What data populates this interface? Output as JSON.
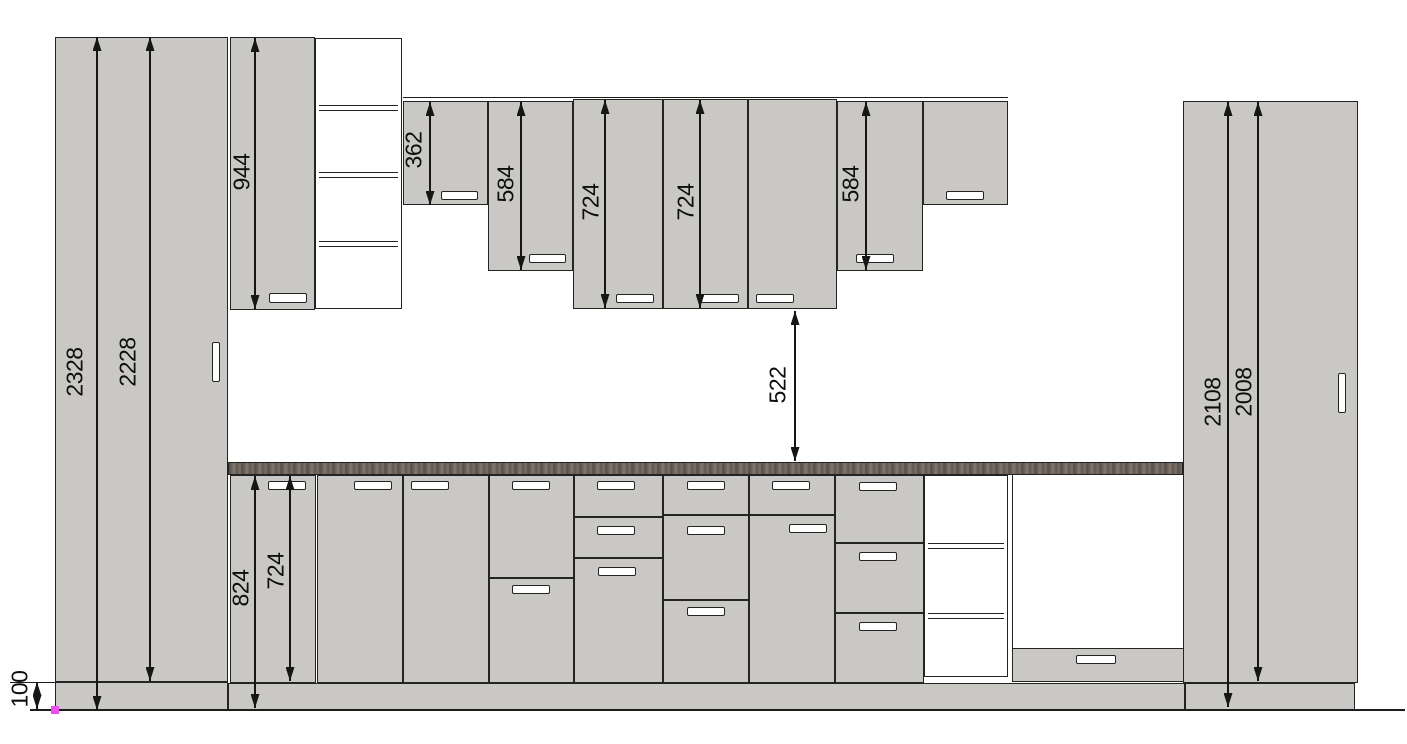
{
  "title": "Kitchen cabinet elevation drawing",
  "units": "mm",
  "colors": {
    "cabinet_fill": "#c9c8c4",
    "outline": "#242424",
    "countertop_dark": "#564e47",
    "countertop_light": "#837970",
    "handle_fill": "#ffffff",
    "dimension": "#161616",
    "origin_marker": "#f24bf2",
    "background": "#ffffff"
  },
  "drawing": {
    "width": 1407,
    "height": 744,
    "rects": [
      {
        "n": "tall-cabinet-left-body",
        "x": 55,
        "y": 37,
        "w": 173,
        "h": 645,
        "f": "cab"
      },
      {
        "n": "tall-cabinet-left-plinth",
        "x": 55,
        "y": 682,
        "w": 173,
        "h": 28,
        "f": "cab"
      },
      {
        "n": "wall-cabinet-944",
        "x": 230,
        "y": 37,
        "w": 85,
        "h": 273,
        "f": "cab"
      },
      {
        "n": "upper-open-shelf-unit",
        "x": 315,
        "y": 38,
        "w": 87,
        "h": 271,
        "f": "white"
      },
      {
        "n": "wall-cabinet-362",
        "x": 403,
        "y": 101,
        "w": 85,
        "h": 104,
        "f": "cab"
      },
      {
        "n": "wall-cabinet-584-left",
        "x": 488,
        "y": 101,
        "w": 85,
        "h": 170,
        "f": "cab"
      },
      {
        "n": "wall-cabinet-724-left",
        "x": 573,
        "y": 99,
        "w": 90,
        "h": 210,
        "f": "cab"
      },
      {
        "n": "wall-cabinet-724-right",
        "x": 663,
        "y": 99,
        "w": 85,
        "h": 210,
        "f": "cab"
      },
      {
        "n": "wall-cabinet-wide",
        "x": 748,
        "y": 99,
        "w": 89,
        "h": 210,
        "f": "cab"
      },
      {
        "n": "wall-cabinet-584-right",
        "x": 837,
        "y": 101,
        "w": 86,
        "h": 170,
        "f": "cab"
      },
      {
        "n": "wall-cabinet-right-end",
        "x": 923,
        "y": 101,
        "w": 85,
        "h": 104,
        "f": "cab"
      },
      {
        "n": "countertop",
        "x": 228,
        "y": 462,
        "w": 955,
        "h": 13,
        "f": "counter"
      },
      {
        "n": "base-door-1",
        "x": 230,
        "y": 475,
        "w": 86,
        "h": 208,
        "f": "cab"
      },
      {
        "n": "base-door-2",
        "x": 317,
        "y": 475,
        "w": 86,
        "h": 208,
        "f": "cab"
      },
      {
        "n": "base-door-3",
        "x": 403,
        "y": 475,
        "w": 86,
        "h": 208,
        "f": "cab"
      },
      {
        "n": "base-4-upper-door",
        "x": 489,
        "y": 475,
        "w": 85,
        "h": 103,
        "f": "cab"
      },
      {
        "n": "base-4-lower-door",
        "x": 489,
        "y": 578,
        "w": 85,
        "h": 105,
        "f": "cab"
      },
      {
        "n": "base-5-drawer-1",
        "x": 574,
        "y": 475,
        "w": 89,
        "h": 42,
        "f": "cab"
      },
      {
        "n": "base-5-drawer-2",
        "x": 574,
        "y": 517,
        "w": 89,
        "h": 41,
        "f": "cab"
      },
      {
        "n": "base-5-door",
        "x": 574,
        "y": 558,
        "w": 89,
        "h": 125,
        "f": "cab"
      },
      {
        "n": "base-6-drawer-1",
        "x": 663,
        "y": 475,
        "w": 86,
        "h": 40,
        "f": "cab"
      },
      {
        "n": "base-6-drawer-2",
        "x": 663,
        "y": 515,
        "w": 86,
        "h": 85,
        "f": "cab"
      },
      {
        "n": "base-6-drawer-3",
        "x": 663,
        "y": 600,
        "w": 86,
        "h": 83,
        "f": "cab"
      },
      {
        "n": "base-7-drawer",
        "x": 749,
        "y": 475,
        "w": 86,
        "h": 40,
        "f": "cab"
      },
      {
        "n": "base-7-door",
        "x": 749,
        "y": 515,
        "w": 86,
        "h": 168,
        "f": "cab"
      },
      {
        "n": "base-8-drawer-1",
        "x": 835,
        "y": 475,
        "w": 89,
        "h": 68,
        "f": "cab"
      },
      {
        "n": "base-8-drawer-2",
        "x": 835,
        "y": 543,
        "w": 89,
        "h": 70,
        "f": "cab"
      },
      {
        "n": "base-8-drawer-3",
        "x": 835,
        "y": 613,
        "w": 89,
        "h": 70,
        "f": "cab"
      },
      {
        "n": "base-open-shelf-unit",
        "x": 924,
        "y": 475,
        "w": 84,
        "h": 202,
        "f": "white"
      },
      {
        "n": "appliance-niche",
        "x": 1012,
        "y": 475,
        "w": 172,
        "h": 207,
        "f": "white",
        "b": "lr"
      },
      {
        "n": "appliance-niche-drawer",
        "x": 1012,
        "y": 648,
        "w": 172,
        "h": 34,
        "f": "cab"
      },
      {
        "n": "base-plinth",
        "x": 228,
        "y": 683,
        "w": 957,
        "h": 27,
        "f": "cab"
      },
      {
        "n": "tall-cabinet-right-body",
        "x": 1183,
        "y": 101,
        "w": 175,
        "h": 582,
        "f": "cab"
      },
      {
        "n": "tall-cabinet-right-plinth",
        "x": 1185,
        "y": 683,
        "w": 170,
        "h": 27,
        "f": "cab"
      }
    ],
    "shelves": [
      {
        "n": "upper-shelf-1",
        "x": 319,
        "y": 105,
        "w": 79
      },
      {
        "n": "upper-shelf-2",
        "x": 319,
        "y": 172,
        "w": 79
      },
      {
        "n": "upper-shelf-3",
        "x": 319,
        "y": 241,
        "w": 79
      },
      {
        "n": "base-shelf-1",
        "x": 928,
        "y": 543,
        "w": 76
      },
      {
        "n": "base-shelf-2",
        "x": 928,
        "y": 613,
        "w": 76
      }
    ],
    "handles": [
      {
        "n": "tall-left-door-handle",
        "x": 212,
        "y": 342,
        "w": 8,
        "h": 40
      },
      {
        "n": "wall-944-handle",
        "x": 269,
        "y": 293,
        "w": 38,
        "h": 10
      },
      {
        "n": "wall-362-handle",
        "x": 441,
        "y": 191,
        "w": 37,
        "h": 9
      },
      {
        "n": "wall-584-left-handle",
        "x": 529,
        "y": 254,
        "w": 37,
        "h": 9
      },
      {
        "n": "wall-724-left-handle",
        "x": 616,
        "y": 294,
        "w": 38,
        "h": 9
      },
      {
        "n": "wall-724-right-handle",
        "x": 701,
        "y": 294,
        "w": 38,
        "h": 9
      },
      {
        "n": "wall-wide-handle",
        "x": 756,
        "y": 294,
        "w": 38,
        "h": 9
      },
      {
        "n": "wall-584-right-handle",
        "x": 856,
        "y": 254,
        "w": 38,
        "h": 9
      },
      {
        "n": "wall-right-end-handle",
        "x": 946,
        "y": 191,
        "w": 38,
        "h": 9
      },
      {
        "n": "base-door-1-handle",
        "x": 268,
        "y": 481,
        "w": 38,
        "h": 9
      },
      {
        "n": "base-door-2-handle",
        "x": 354,
        "y": 481,
        "w": 38,
        "h": 9
      },
      {
        "n": "base-door-3-handle",
        "x": 411,
        "y": 481,
        "w": 38,
        "h": 9
      },
      {
        "n": "base-4-upper-handle",
        "x": 512,
        "y": 481,
        "w": 38,
        "h": 9
      },
      {
        "n": "base-4-lower-handle",
        "x": 512,
        "y": 585,
        "w": 38,
        "h": 9
      },
      {
        "n": "base-5-drawer-1-handle",
        "x": 597,
        "y": 481,
        "w": 38,
        "h": 9
      },
      {
        "n": "base-5-drawer-2-handle",
        "x": 597,
        "y": 526,
        "w": 38,
        "h": 9
      },
      {
        "n": "base-5-door-handle",
        "x": 598,
        "y": 567,
        "w": 38,
        "h": 9
      },
      {
        "n": "base-6-drawer-1-handle",
        "x": 687,
        "y": 481,
        "w": 38,
        "h": 9
      },
      {
        "n": "base-6-drawer-2-handle",
        "x": 687,
        "y": 526,
        "w": 38,
        "h": 9
      },
      {
        "n": "base-6-drawer-3-handle",
        "x": 687,
        "y": 607,
        "w": 38,
        "h": 9
      },
      {
        "n": "base-7-drawer-handle",
        "x": 772,
        "y": 481,
        "w": 38,
        "h": 9
      },
      {
        "n": "base-7-door-handle",
        "x": 789,
        "y": 524,
        "w": 38,
        "h": 9
      },
      {
        "n": "base-8-drawer-1-handle",
        "x": 859,
        "y": 482,
        "w": 38,
        "h": 9
      },
      {
        "n": "base-8-drawer-2-handle",
        "x": 859,
        "y": 552,
        "w": 38,
        "h": 9
      },
      {
        "n": "base-8-drawer-3-handle",
        "x": 859,
        "y": 622,
        "w": 38,
        "h": 9
      },
      {
        "n": "niche-drawer-handle",
        "x": 1076,
        "y": 655,
        "w": 40,
        "h": 9
      },
      {
        "n": "tall-right-door-handle",
        "x": 1338,
        "y": 373,
        "w": 8,
        "h": 40
      }
    ],
    "lines": [
      {
        "n": "floor-line",
        "x": 30,
        "y": 709,
        "w": 1375,
        "h": 2
      },
      {
        "n": "plinth-extension-line",
        "x": 10,
        "y": 681.8,
        "w": 45,
        "h": 1.3
      },
      {
        "n": "upper-row-extension-line",
        "x": 403,
        "y": 96.5,
        "w": 605,
        "h": 1.3
      }
    ],
    "dims": [
      {
        "v": "2328",
        "x": 97,
        "y1": 37,
        "y2": 710,
        "lx": 75,
        "ly": 372
      },
      {
        "v": "2228",
        "x": 150,
        "y1": 37,
        "y2": 681,
        "lx": 128,
        "ly": 362
      },
      {
        "v": "944",
        "x": 255,
        "y1": 38,
        "y2": 309,
        "lx": 242,
        "ly": 172
      },
      {
        "v": "362",
        "x": 430,
        "y1": 102,
        "y2": 205,
        "lx": 414,
        "ly": 150
      },
      {
        "v": "584",
        "x": 521,
        "y1": 102,
        "y2": 270,
        "lx": 506,
        "ly": 184
      },
      {
        "v": "724",
        "x": 605,
        "y1": 100,
        "y2": 308,
        "lx": 591,
        "ly": 202
      },
      {
        "v": "724",
        "x": 700,
        "y1": 100,
        "y2": 308,
        "lx": 686,
        "ly": 202
      },
      {
        "v": "584",
        "x": 866,
        "y1": 102,
        "y2": 270,
        "lx": 851,
        "ly": 184
      },
      {
        "v": "522",
        "x": 795,
        "y1": 311,
        "y2": 461,
        "lx": 778,
        "ly": 385
      },
      {
        "v": "824",
        "x": 255,
        "y1": 476,
        "y2": 708,
        "lx": 241,
        "ly": 588
      },
      {
        "v": "724",
        "x": 290,
        "y1": 476,
        "y2": 681,
        "lx": 276,
        "ly": 571
      },
      {
        "v": "100",
        "x": 37,
        "y1": 682,
        "y2": 709,
        "lx": 20,
        "ly": 689
      },
      {
        "v": "2108",
        "x": 1228,
        "y1": 102,
        "y2": 707,
        "lx": 1213,
        "ly": 402
      },
      {
        "v": "2008",
        "x": 1258,
        "y1": 102,
        "y2": 681,
        "lx": 1244,
        "ly": 392
      }
    ],
    "marker": {
      "n": "origin-marker",
      "x": 51,
      "y": 706,
      "size": 8
    }
  }
}
